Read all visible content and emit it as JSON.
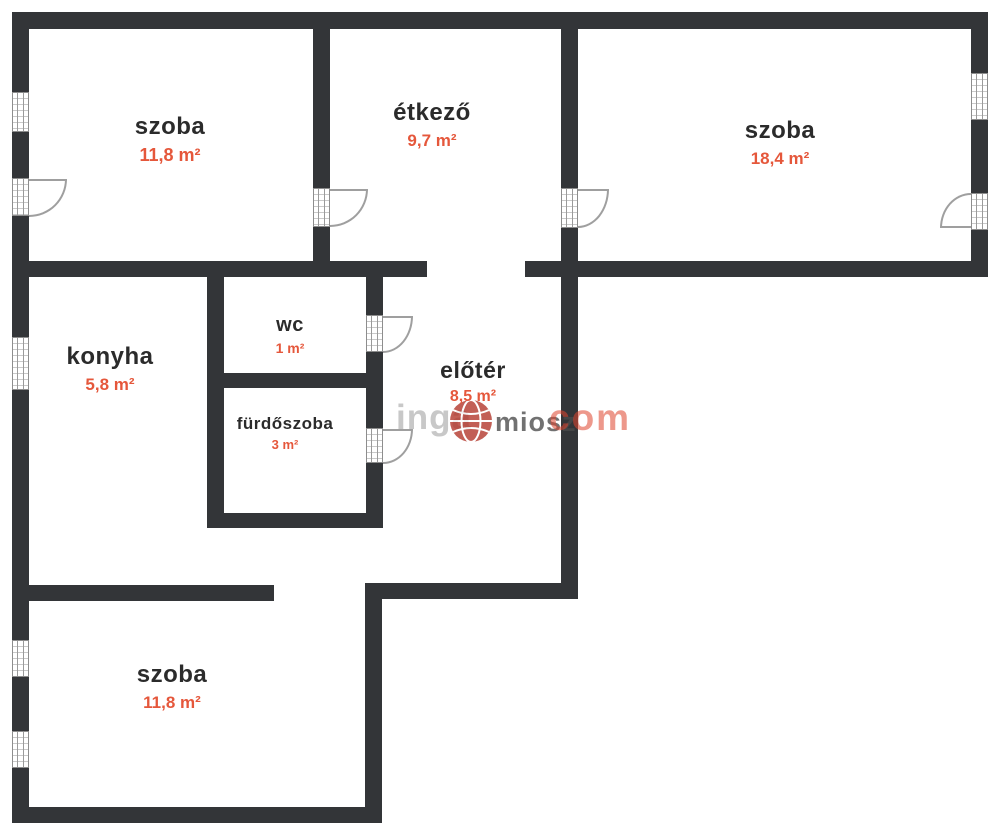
{
  "rooms": {
    "szoba_tl": {
      "name": "szoba",
      "area": "11,8 m²"
    },
    "etkezo": {
      "name": "étkező",
      "area": "9,7 m²"
    },
    "szoba_tr": {
      "name": "szoba",
      "area": "18,4 m²"
    },
    "konyha": {
      "name": "konyha",
      "area": "5,8 m²"
    },
    "wc": {
      "name": "wc",
      "area": "1 m²"
    },
    "furdoszoba": {
      "name": "fürdőszoba",
      "area": "3 m²"
    },
    "eloter": {
      "name": "előtér",
      "area": "8,5 m²"
    },
    "szoba_b": {
      "name": "szoba",
      "area": "11,8 m²"
    }
  },
  "watermark": {
    "part1": "inga",
    "part2": "miosz",
    "part3": "com"
  },
  "colors": {
    "wall": "#333538",
    "room_name": "#2b2b2b",
    "area_accent": "#e5573b",
    "background": "#ffffff",
    "watermark_gray": "#a8a8a8",
    "watermark_red": "#e0442e",
    "door_line": "#9f9f9f"
  }
}
